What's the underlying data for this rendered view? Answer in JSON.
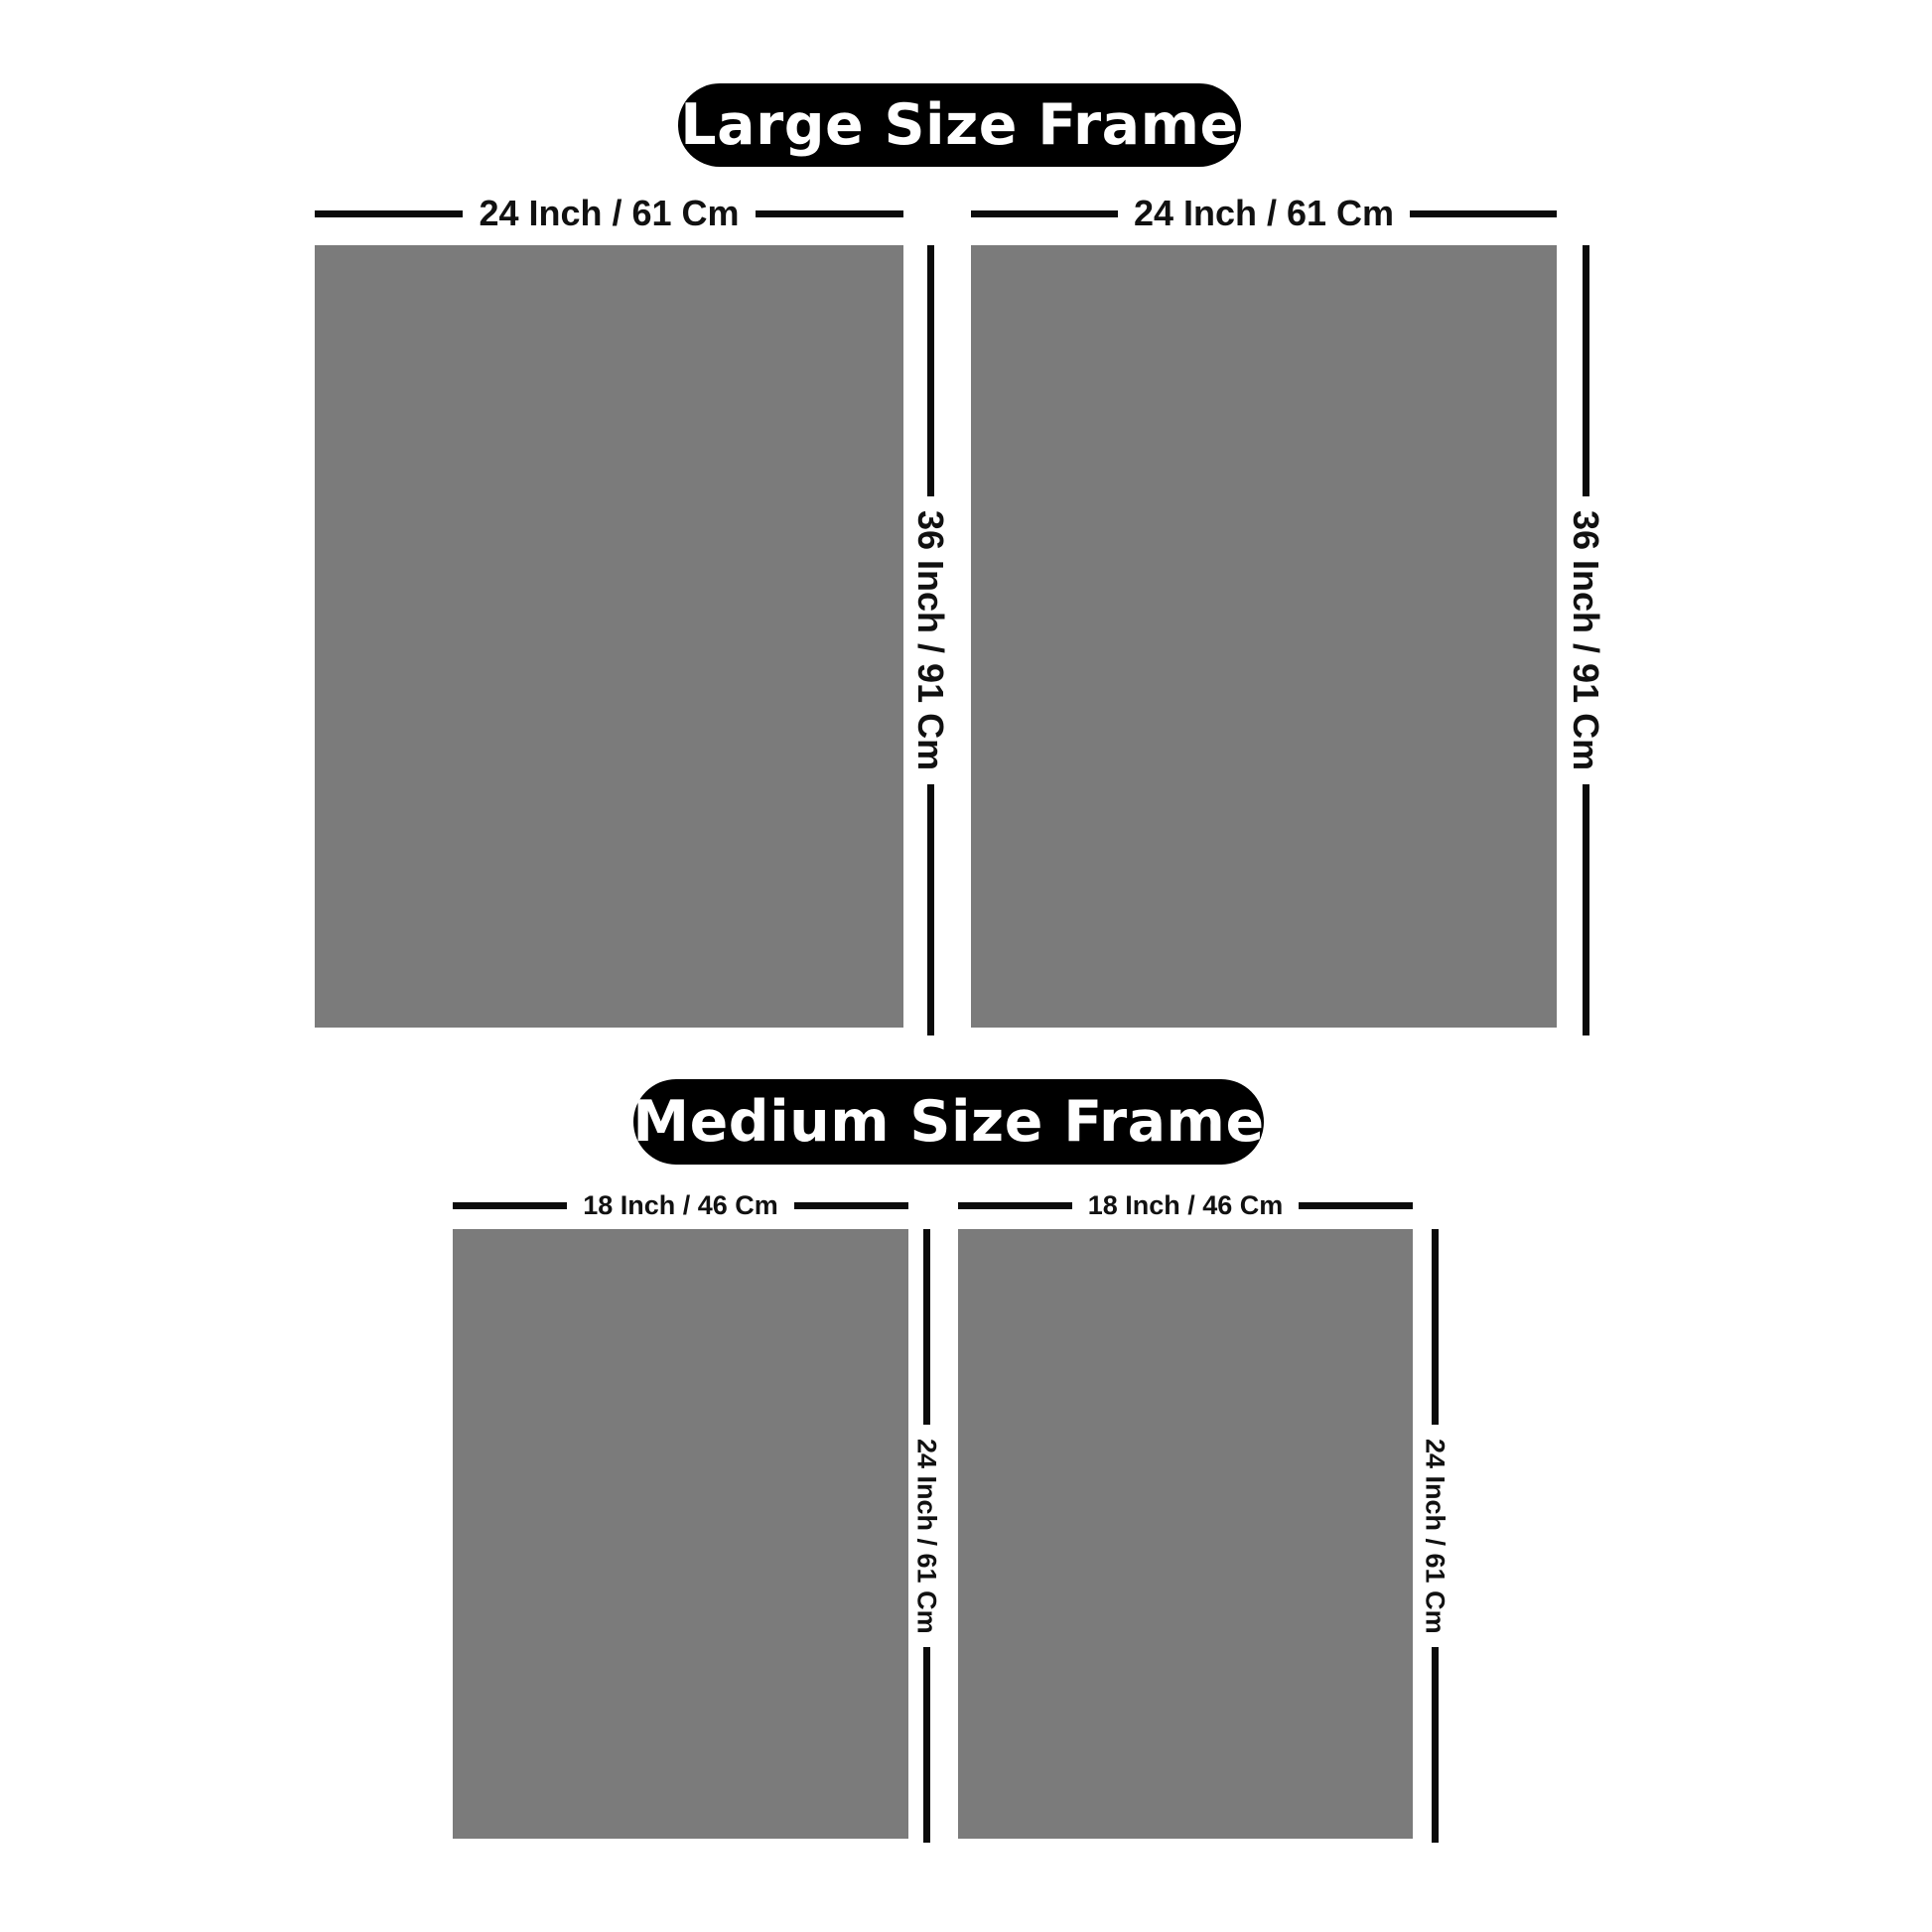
{
  "page": {
    "background": "#ffffff",
    "colors": {
      "frame_fill": "#7b7b7b",
      "dimension_line": "#0b0b0b",
      "title_bg": "#000000",
      "title_text": "#ffffff"
    }
  },
  "sections": [
    {
      "title": "Large Size Frame",
      "frames": [
        {
          "width_label": "24 Inch / 61 Cm",
          "height_label": "36 Inch / 91 Cm"
        },
        {
          "width_label": "24 Inch / 61 Cm",
          "height_label": "36 Inch / 91 Cm"
        }
      ]
    },
    {
      "title": "Medium Size Frame",
      "frames": [
        {
          "width_label": "18 Inch / 46 Cm",
          "height_label": "24 Inch / 61 Cm"
        },
        {
          "width_label": "18 Inch / 46 Cm",
          "height_label": "24 Inch / 61 Cm"
        }
      ]
    }
  ]
}
